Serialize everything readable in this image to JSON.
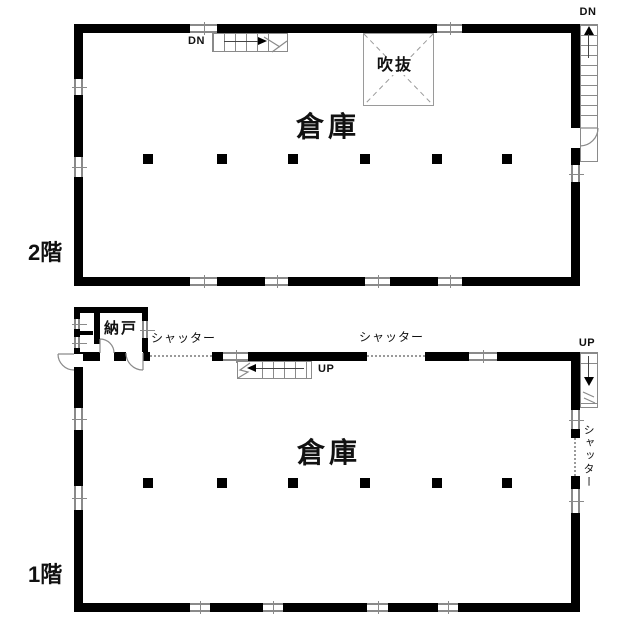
{
  "colors": {
    "wall": "#000000",
    "thin_line": "#8a8a8a",
    "background": "#ffffff"
  },
  "floor2": {
    "floor_label": "2階",
    "room_label": "倉庫",
    "void_label": "吹抜",
    "interior_stair_label": "DN",
    "exterior_stair_label": "DN"
  },
  "floor1": {
    "floor_label": "1階",
    "room_label": "倉庫",
    "storage_room_label": "納戸",
    "shutter_label_left": "シャッター",
    "shutter_label_center": "シャッター",
    "shutter_label_right": "シャッター",
    "interior_stair_label": "UP",
    "exterior_stair_label": "UP"
  }
}
